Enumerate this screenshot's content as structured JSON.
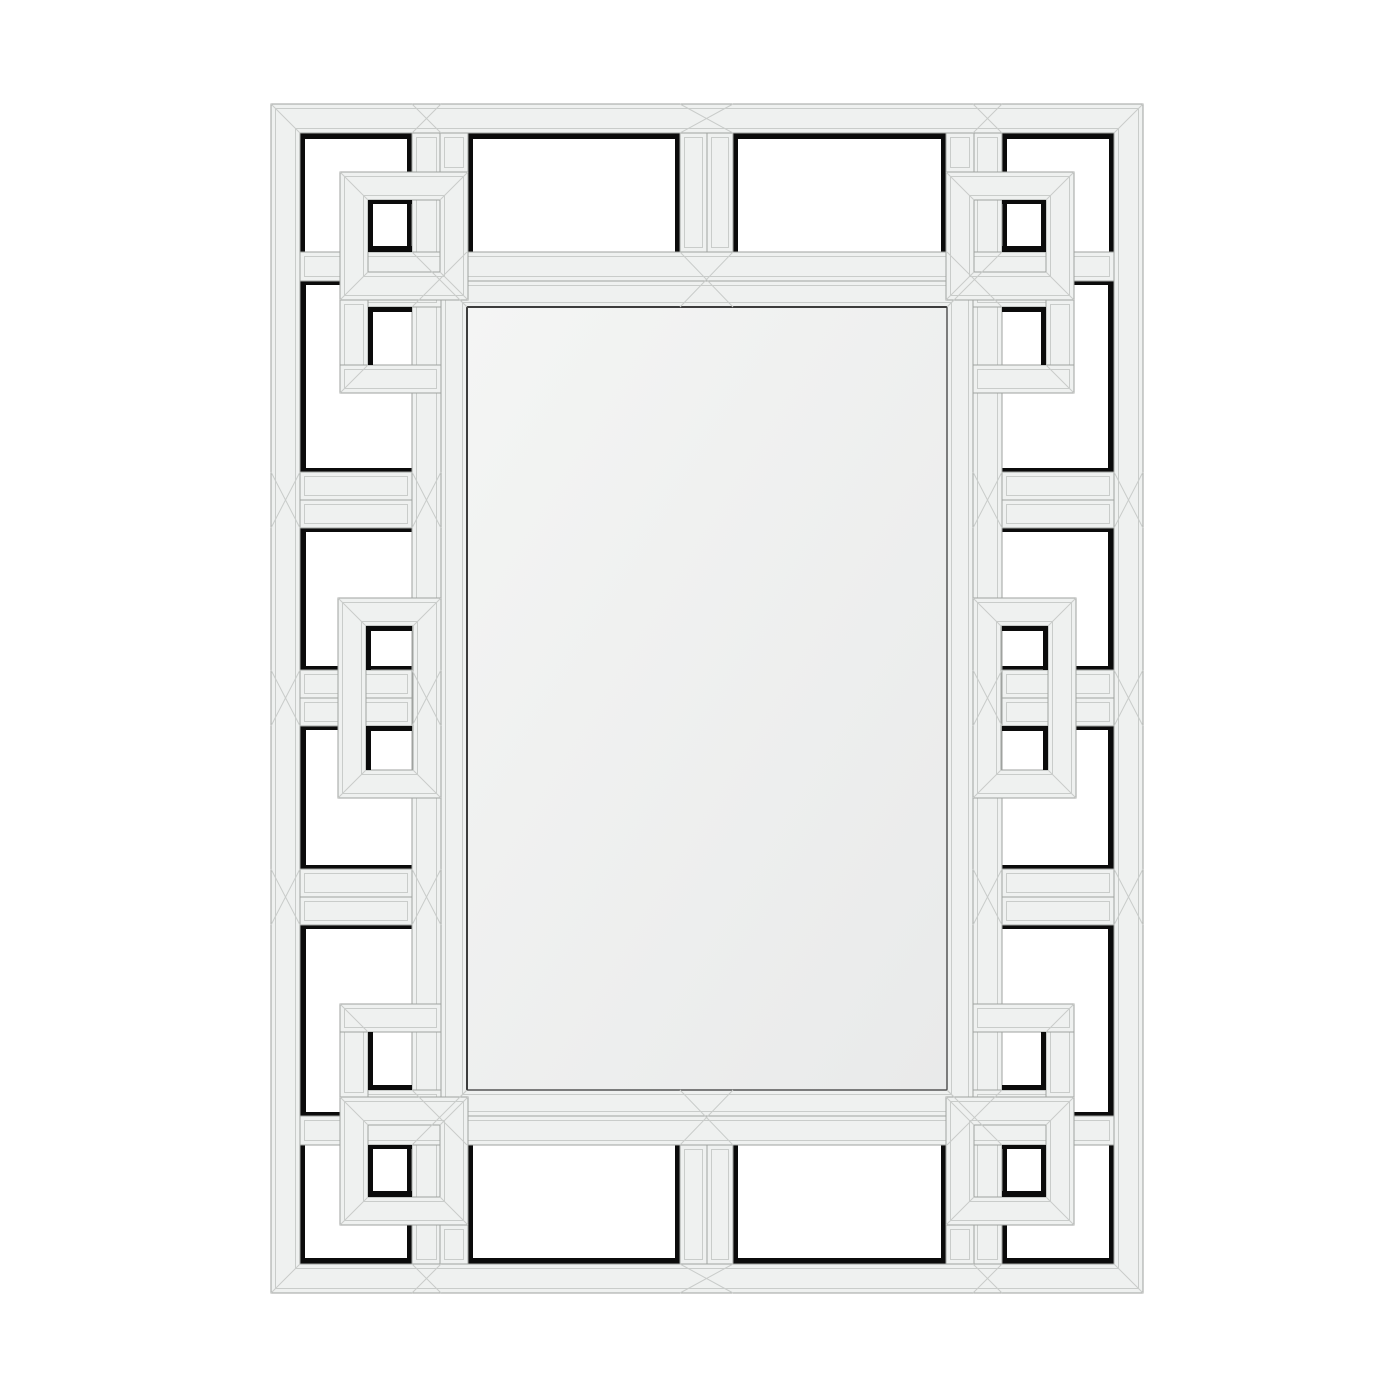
{
  "image": {
    "kind": "product-photo",
    "subject": "greek-key-fretwork-wall-mirror",
    "canvas": {
      "w": 1400,
      "h": 1400
    }
  },
  "colors": {
    "background": "#ffffff",
    "plank_face": "#eff1f0",
    "plank_face_alt": "#ecedec",
    "plank_edge": "#9fa29f",
    "bevel_seam": "#c9ccca",
    "shadow_black": "#0b0b0b",
    "mirror_light": "#f4f5f4",
    "mirror_dark": "#e9eaea",
    "mirror_edge": "#4a4a4a"
  },
  "mirror_panel": {
    "rect": [
      467,
      307,
      480,
      783
    ]
  },
  "scene": {
    "rings": [
      {
        "name": "outer-ring",
        "r": [
          271,
          104,
          872,
          1189
        ],
        "t": 29
      },
      {
        "name": "frame-ring",
        "r": [
          441,
          281,
          532,
          835
        ],
        "t": 26
      },
      {
        "name": "corner-ring-tl",
        "r": [
          340,
          172,
          128,
          128
        ],
        "t": 28
      },
      {
        "name": "corner-ring-tr",
        "r": [
          946,
          172,
          128,
          128
        ],
        "t": 28
      },
      {
        "name": "corner-ring-bl",
        "r": [
          340,
          1097,
          128,
          128
        ],
        "t": 28
      },
      {
        "name": "corner-ring-br",
        "r": [
          946,
          1097,
          128,
          128
        ],
        "t": 28
      },
      {
        "name": "middle-ring-left",
        "r": [
          338,
          598,
          103,
          200
        ],
        "t": 28
      },
      {
        "name": "middle-ring-right",
        "r": [
          973,
          598,
          103,
          200
        ],
        "t": 28
      }
    ],
    "bars": [
      {
        "name": "col-left",
        "r": [
          412,
          133,
          29,
          1131
        ]
      },
      {
        "name": "col-right",
        "r": [
          973,
          133,
          29,
          1131
        ]
      },
      {
        "name": "row-top",
        "r": [
          300,
          252,
          814,
          29
        ]
      },
      {
        "name": "row-bottom",
        "r": [
          300,
          1116,
          814,
          29
        ]
      },
      {
        "name": "top-col-a",
        "r": [
          680,
          133,
          27,
          119
        ]
      },
      {
        "name": "top-col-b",
        "r": [
          707,
          133,
          26,
          119
        ]
      },
      {
        "name": "bottom-col-a",
        "r": [
          680,
          1145,
          27,
          119
        ]
      },
      {
        "name": "bottom-col-b",
        "r": [
          707,
          1145,
          26,
          119
        ]
      },
      {
        "name": "rung-l1a",
        "r": [
          300,
          472,
          112,
          28
        ]
      },
      {
        "name": "rung-l1b",
        "r": [
          300,
          500,
          112,
          28
        ]
      },
      {
        "name": "rung-l2a",
        "r": [
          300,
          670,
          112,
          28
        ]
      },
      {
        "name": "rung-l2b",
        "r": [
          300,
          698,
          112,
          28
        ]
      },
      {
        "name": "rung-l3a",
        "r": [
          300,
          869,
          112,
          28
        ]
      },
      {
        "name": "rung-l3b",
        "r": [
          300,
          897,
          112,
          28
        ]
      },
      {
        "name": "rung-r1a",
        "r": [
          1002,
          472,
          112,
          28
        ]
      },
      {
        "name": "rung-r1b",
        "r": [
          1002,
          500,
          112,
          28
        ]
      },
      {
        "name": "rung-r2a",
        "r": [
          1002,
          670,
          112,
          28
        ]
      },
      {
        "name": "rung-r2b",
        "r": [
          1002,
          698,
          112,
          28
        ]
      },
      {
        "name": "rung-r3a",
        "r": [
          1002,
          869,
          112,
          28
        ]
      },
      {
        "name": "rung-r3b",
        "r": [
          1002,
          897,
          112,
          28
        ]
      },
      {
        "name": "ext-tl",
        "r": [
          340,
          281,
          101,
          26
        ]
      },
      {
        "name": "ext-tr",
        "r": [
          973,
          281,
          101,
          26
        ]
      },
      {
        "name": "ext-bl",
        "r": [
          340,
          1090,
          101,
          26
        ]
      },
      {
        "name": "ext-br",
        "r": [
          973,
          1090,
          101,
          26
        ]
      },
      {
        "name": "stub-tl",
        "r": [
          440,
          133,
          28,
          39
        ]
      },
      {
        "name": "stub-tr",
        "r": [
          946,
          133,
          28,
          39
        ]
      },
      {
        "name": "stub-bl",
        "r": [
          440,
          1225,
          28,
          39
        ]
      },
      {
        "name": "stub-br",
        "r": [
          946,
          1225,
          28,
          39
        ]
      },
      {
        "name": "hook-v-tl",
        "r": [
          340,
          300,
          28,
          93
        ]
      },
      {
        "name": "hook-h-tl",
        "r": [
          340,
          365,
          101,
          28
        ]
      },
      {
        "name": "hook-v-tr",
        "r": [
          1046,
          300,
          28,
          93
        ]
      },
      {
        "name": "hook-h-tr",
        "r": [
          973,
          365,
          101,
          28
        ]
      },
      {
        "name": "hook-v-bl",
        "r": [
          340,
          1004,
          28,
          93
        ]
      },
      {
        "name": "hook-h-bl",
        "r": [
          340,
          1004,
          101,
          28
        ]
      },
      {
        "name": "hook-v-br",
        "r": [
          1046,
          1004,
          28,
          93
        ]
      },
      {
        "name": "hook-h-br",
        "r": [
          973,
          1004,
          101,
          28
        ]
      }
    ],
    "openings_under": [
      {
        "name": "top-1",
        "r": [
          300,
          133,
          112,
          119
        ],
        "black": {
          "top": 6,
          "left": 5,
          "right": 5
        }
      },
      {
        "name": "top-2",
        "r": [
          468,
          133,
          212,
          119
        ],
        "black": {
          "top": 6,
          "left": 5,
          "right": 5
        }
      },
      {
        "name": "top-3",
        "r": [
          733,
          133,
          213,
          119
        ],
        "black": {
          "top": 6,
          "left": 5,
          "right": 5
        }
      },
      {
        "name": "top-4",
        "r": [
          1002,
          133,
          112,
          119
        ],
        "black": {
          "top": 6,
          "left": 5,
          "right": 5
        }
      },
      {
        "name": "bottom-1",
        "r": [
          300,
          1145,
          112,
          119
        ],
        "black": {
          "bottom": 6,
          "left": 5,
          "right": 5
        }
      },
      {
        "name": "bottom-2",
        "r": [
          468,
          1145,
          212,
          119
        ],
        "black": {
          "bottom": 6,
          "left": 5,
          "right": 5
        }
      },
      {
        "name": "bottom-3",
        "r": [
          733,
          1145,
          213,
          119
        ],
        "black": {
          "bottom": 6,
          "left": 5,
          "right": 5
        }
      },
      {
        "name": "bottom-4",
        "r": [
          1002,
          1145,
          112,
          119
        ],
        "black": {
          "bottom": 6,
          "left": 5,
          "right": 5
        }
      },
      {
        "name": "left-1",
        "r": [
          300,
          281,
          112,
          191
        ],
        "black": {
          "left": 6,
          "top": 4,
          "bottom": 4
        }
      },
      {
        "name": "left-2",
        "r": [
          300,
          528,
          112,
          142
        ],
        "black": {
          "left": 6,
          "top": 4,
          "bottom": 4
        }
      },
      {
        "name": "left-3",
        "r": [
          300,
          726,
          112,
          143
        ],
        "black": {
          "left": 6,
          "top": 4,
          "bottom": 4
        }
      },
      {
        "name": "left-4",
        "r": [
          300,
          925,
          112,
          191
        ],
        "black": {
          "left": 6,
          "top": 4,
          "bottom": 4
        }
      },
      {
        "name": "right-1",
        "r": [
          1002,
          281,
          112,
          191
        ],
        "black": {
          "right": 6,
          "top": 4,
          "bottom": 4
        }
      },
      {
        "name": "right-2",
        "r": [
          1002,
          528,
          112,
          142
        ],
        "black": {
          "right": 6,
          "top": 4,
          "bottom": 4
        }
      },
      {
        "name": "right-3",
        "r": [
          1002,
          726,
          112,
          143
        ],
        "black": {
          "right": 6,
          "top": 4,
          "bottom": 4
        }
      },
      {
        "name": "right-4",
        "r": [
          1002,
          925,
          112,
          191
        ],
        "black": {
          "right": 6,
          "top": 4,
          "bottom": 4
        }
      }
    ],
    "openings_over": [
      {
        "name": "small-tl-1",
        "r": [
          368,
          200,
          44,
          52
        ],
        "black": {
          "left": 5,
          "top": 4,
          "bottom": 6
        }
      },
      {
        "name": "small-tl-2",
        "r": [
          368,
          307,
          44,
          58
        ],
        "black": {
          "left": 5,
          "top": 5
        }
      },
      {
        "name": "small-tr-1",
        "r": [
          1002,
          200,
          44,
          52
        ],
        "black": {
          "right": 5,
          "top": 4,
          "bottom": 6
        }
      },
      {
        "name": "small-tr-2",
        "r": [
          1002,
          307,
          44,
          58
        ],
        "black": {
          "right": 5,
          "top": 5
        }
      },
      {
        "name": "small-bl-1",
        "r": [
          368,
          1145,
          44,
          52
        ],
        "black": {
          "left": 5,
          "bottom": 6,
          "top": 4
        }
      },
      {
        "name": "small-bl-2",
        "r": [
          368,
          1032,
          44,
          58
        ],
        "black": {
          "left": 5,
          "bottom": 5
        }
      },
      {
        "name": "small-br-1",
        "r": [
          1002,
          1145,
          44,
          52
        ],
        "black": {
          "right": 5,
          "bottom": 6,
          "top": 4
        }
      },
      {
        "name": "small-br-2",
        "r": [
          1002,
          1032,
          44,
          58
        ],
        "black": {
          "right": 5,
          "bottom": 5
        }
      },
      {
        "name": "small-ml-1",
        "r": [
          366,
          626,
          46,
          44
        ],
        "black": {
          "left": 5,
          "top": 5
        }
      },
      {
        "name": "small-ml-2",
        "r": [
          366,
          726,
          46,
          44
        ],
        "black": {
          "left": 5,
          "top": 5
        }
      },
      {
        "name": "small-mr-1",
        "r": [
          1002,
          626,
          46,
          44
        ],
        "black": {
          "right": 5,
          "top": 5
        }
      },
      {
        "name": "small-mr-2",
        "r": [
          1002,
          726,
          46,
          44
        ],
        "black": {
          "right": 5,
          "top": 5
        }
      }
    ],
    "junction_blocks": [
      [
        680,
        104,
        53,
        29
      ],
      [
        680,
        252,
        53,
        55
      ],
      [
        680,
        1090,
        53,
        55
      ],
      [
        680,
        1264,
        53,
        29
      ],
      [
        412,
        104,
        29,
        29
      ],
      [
        973,
        104,
        29,
        29
      ],
      [
        412,
        1264,
        29,
        29
      ],
      [
        973,
        1264,
        29,
        29
      ],
      [
        271,
        472,
        29,
        56
      ],
      [
        271,
        670,
        29,
        56
      ],
      [
        271,
        869,
        29,
        56
      ],
      [
        1114,
        472,
        29,
        56
      ],
      [
        1114,
        670,
        29,
        56
      ],
      [
        1114,
        869,
        29,
        56
      ],
      [
        412,
        472,
        29,
        56
      ],
      [
        412,
        670,
        29,
        56
      ],
      [
        412,
        869,
        29,
        56
      ],
      [
        973,
        472,
        29,
        56
      ],
      [
        973,
        670,
        29,
        56
      ],
      [
        973,
        869,
        29,
        56
      ],
      [
        412,
        252,
        55,
        55
      ],
      [
        947,
        252,
        55,
        55
      ],
      [
        412,
        1090,
        55,
        55
      ],
      [
        947,
        1090,
        55,
        55
      ]
    ],
    "extra_diagonals": [
      [
        340,
        393,
        368,
        365
      ],
      [
        1074,
        393,
        1046,
        365
      ],
      [
        340,
        1004,
        368,
        1032
      ],
      [
        1074,
        1004,
        1046,
        1032
      ]
    ]
  }
}
